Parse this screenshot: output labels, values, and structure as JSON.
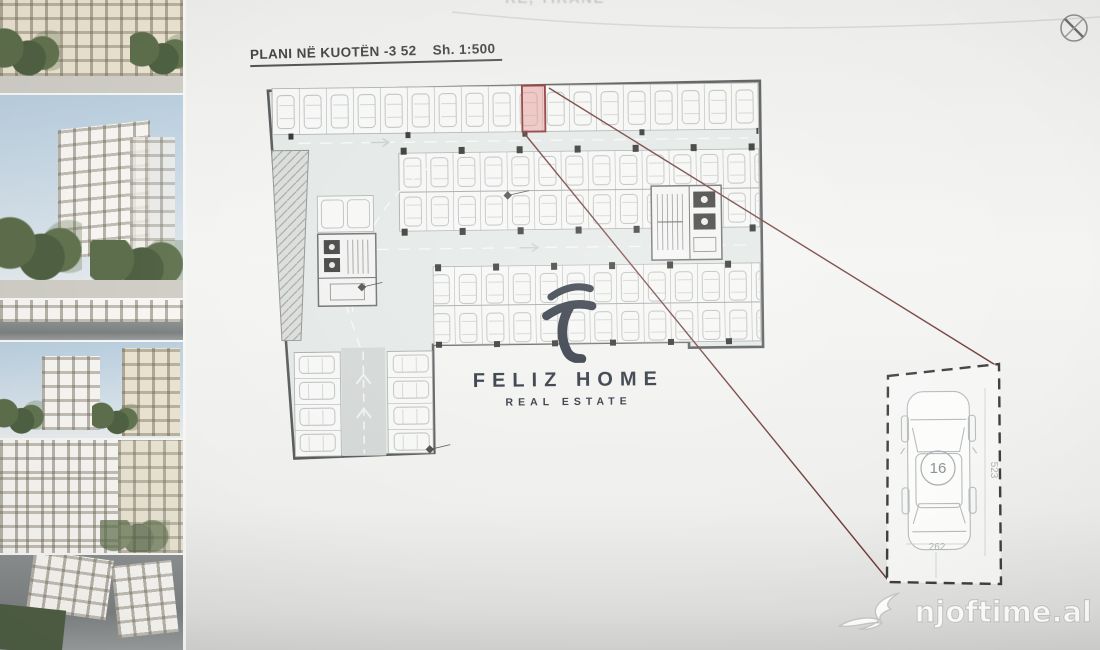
{
  "header": {
    "cutoff_text": "RE, TIRANE"
  },
  "plan": {
    "title": "PLANI NË KUOTËN -3 52",
    "scale": "Sh. 1:500",
    "highlighted_stall": "16"
  },
  "detail": {
    "stall_number": "16",
    "length_label": "523",
    "width_label": "262"
  },
  "logo": {
    "name": "FELIZ HOME",
    "tagline": "REAL ESTATE"
  },
  "watermark": {
    "site": "njoftime.al"
  },
  "colors": {
    "accent_red": "#8a3434",
    "stall_fill": "#e28e8a",
    "callout_line": "#6f3b38",
    "logo_navy": "#272e3a",
    "aisle_tint": "#e3e8e6",
    "paper": "#f6f7f5"
  }
}
